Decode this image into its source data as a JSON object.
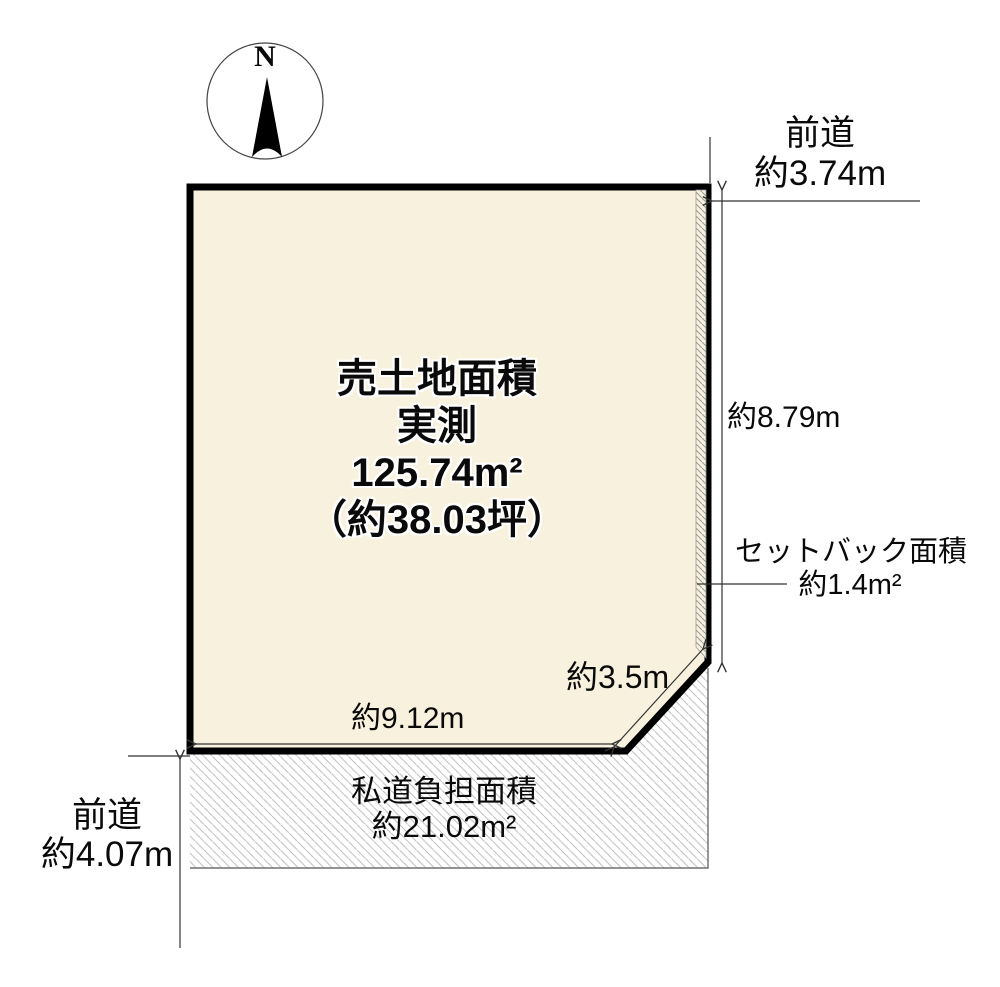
{
  "diagram": {
    "compass": {
      "north_label": "N"
    },
    "parcel": {
      "title_line1": "売土地面積",
      "title_line2": "実測",
      "title_line3": "125.74m²",
      "title_line4": "（約38.03坪）"
    },
    "dimensions": {
      "front_road_top_label": "前道",
      "front_road_top_value": "約3.74m",
      "east_side_value": "約8.79m",
      "setback_label": "セットバック面積",
      "setback_value": "約1.4m²",
      "chamfer_value": "約3.5m",
      "south_side_value": "約9.12m",
      "private_road_label": "私道負担面積",
      "private_road_value": "約21.02m²",
      "front_road_left_label": "前道",
      "front_road_left_value": "約4.07m"
    },
    "colors": {
      "parcel_fill": "#F8F1DE",
      "boundary": "#000000",
      "road_hatch": "#c4c4c4",
      "strip_hatch": "#9a9a9a",
      "dimension_line": "#333333"
    }
  }
}
